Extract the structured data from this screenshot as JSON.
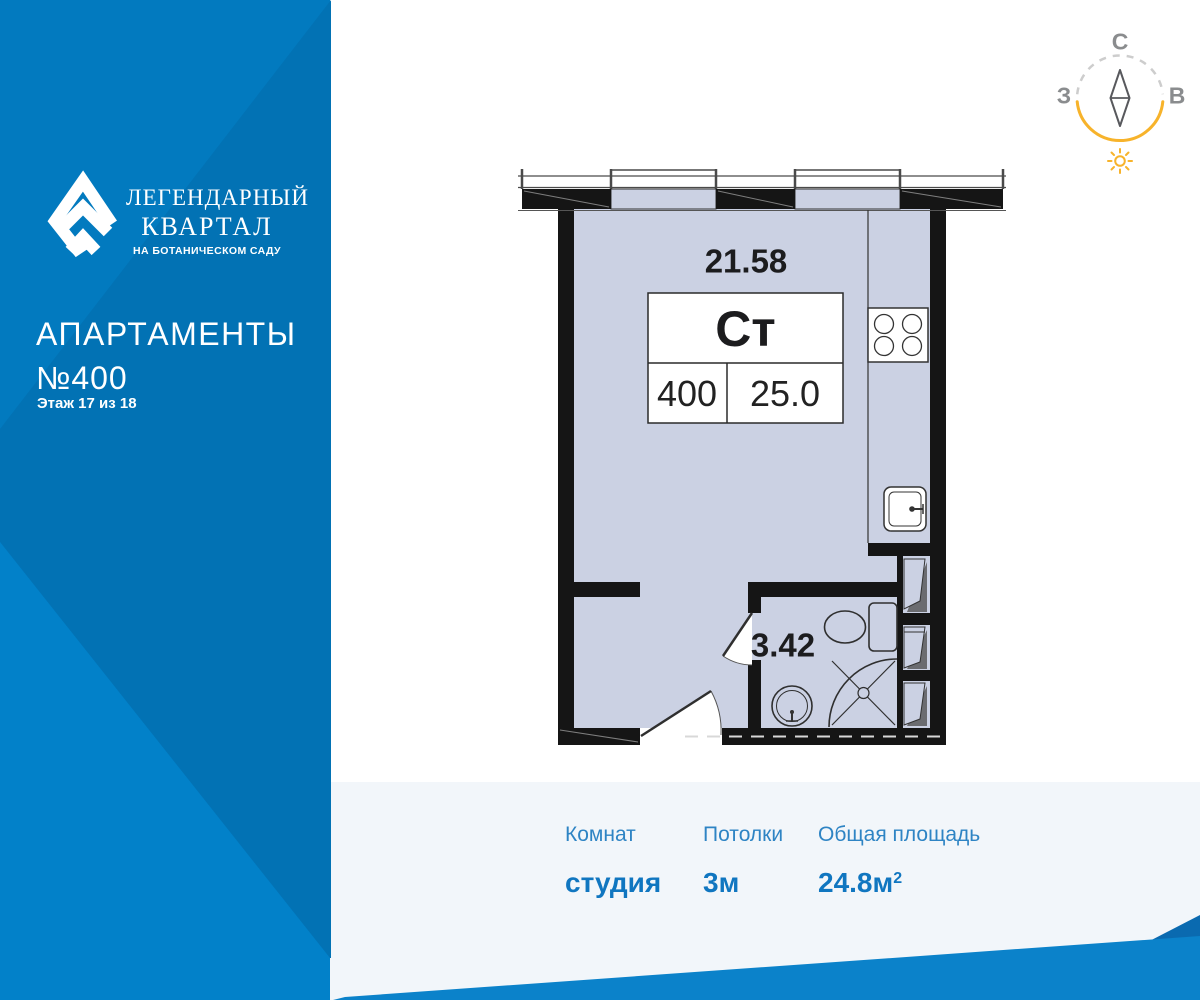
{
  "brand": {
    "name_line1": "ЛЕГЕНДАРНЫЙ",
    "name_line2": "КВАРТАЛ",
    "tagline": "НА БОТАНИЧЕСКОМ САДУ"
  },
  "listing": {
    "type_title": "АПАРТАМЕНТЫ",
    "number": "№400",
    "floor_note": "Этаж 17 из 18"
  },
  "compass": {
    "north": "С",
    "west": "З",
    "east": "В"
  },
  "plan": {
    "main_room_area": "21.58",
    "unit_code": "Ст",
    "unit_number": "400",
    "unit_area": "25.0",
    "bathroom_area": "3.42"
  },
  "summary": {
    "columns": [
      {
        "label": "Комнат",
        "value": "студия",
        "sup": ""
      },
      {
        "label": "Потолки",
        "value": "3м",
        "sup": ""
      },
      {
        "label": "Общая площадь",
        "value": "24.8м",
        "sup": "2"
      }
    ]
  },
  "colors": {
    "brand_blue": "#0277BD",
    "panel_blue_dark": "#0272B4",
    "panel_blue_light": "#0281C9",
    "accent_yellow": "#F7B32B",
    "room_fill": "#CBD1E3",
    "text_blue": "#1076C0",
    "bottom_panel_gray": "#F2F6FA"
  }
}
